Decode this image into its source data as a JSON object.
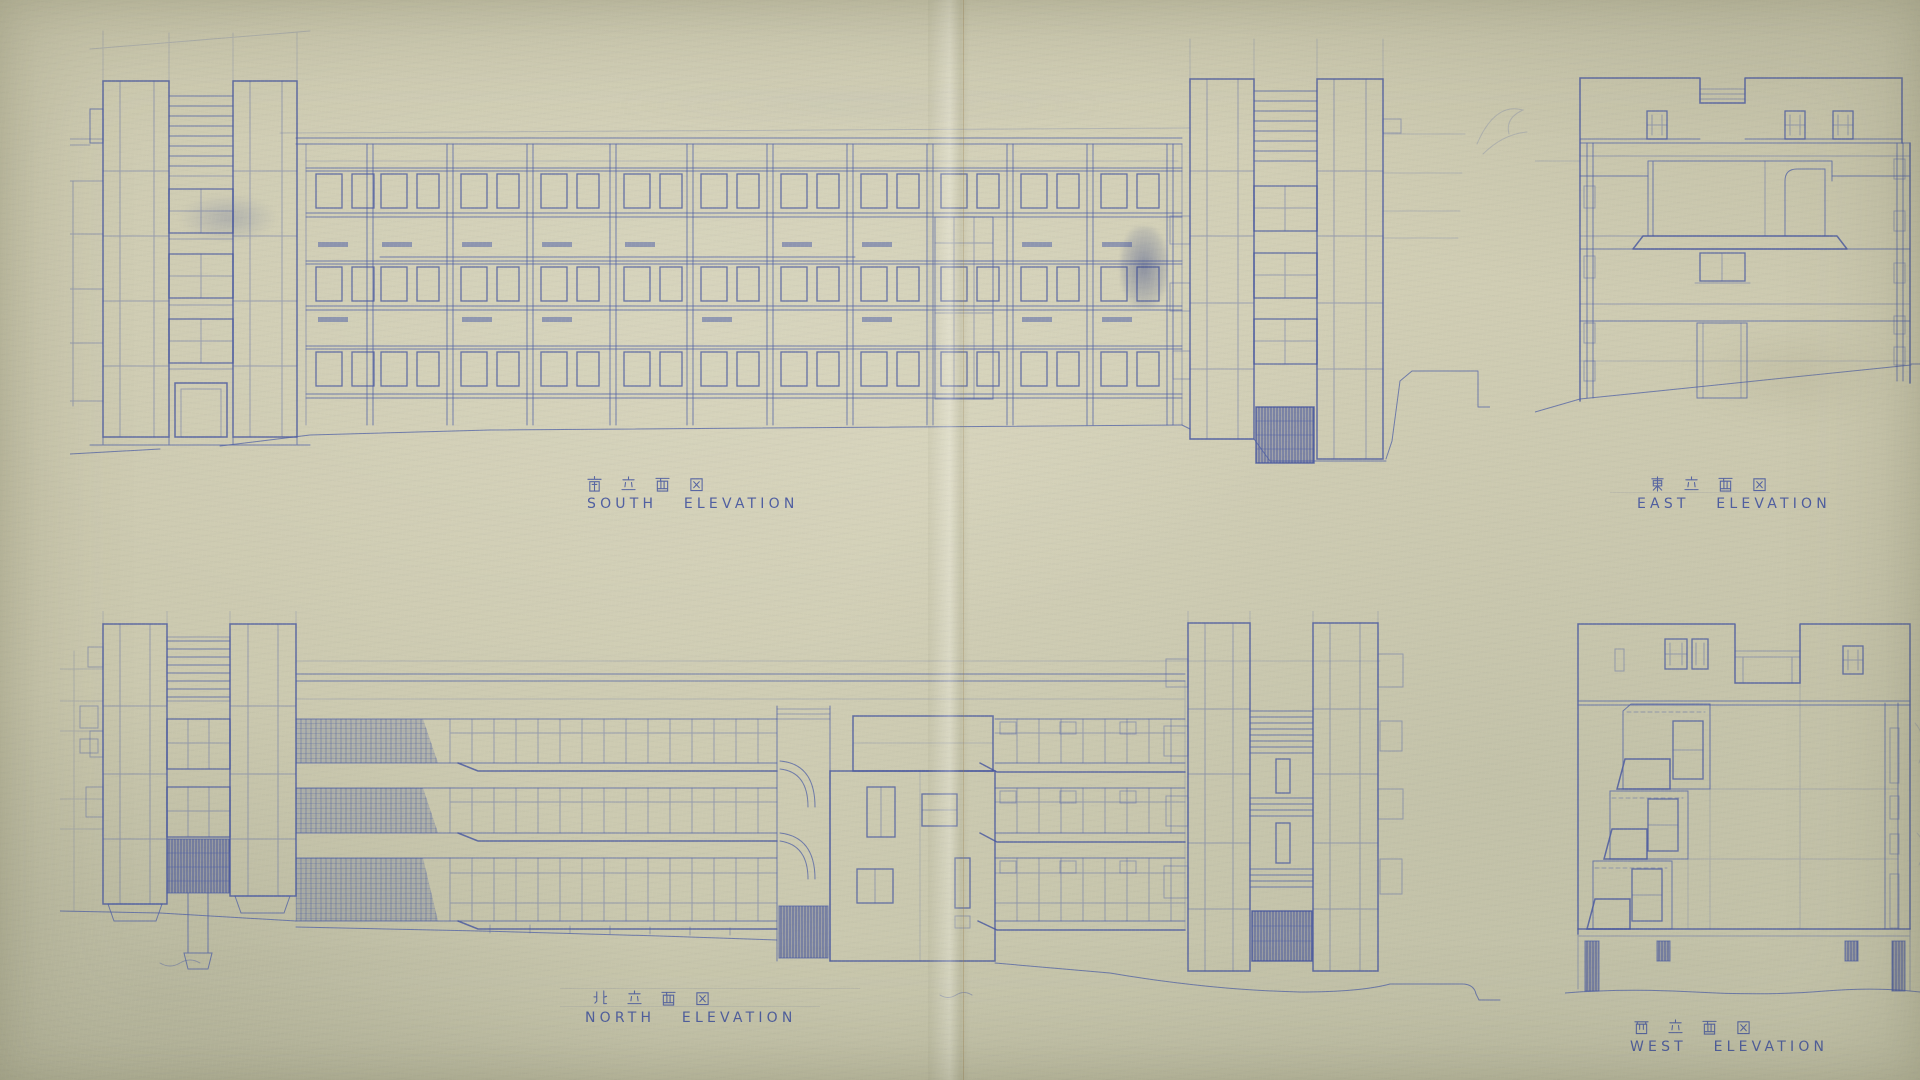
{
  "sheet": {
    "paper_color": "#cbc8ae",
    "ink_color": "#4a5ba5"
  },
  "elevations": {
    "south": {
      "kanji": "南立面図",
      "english": "SOUTH ELEVATION"
    },
    "east": {
      "kanji": "東立面図",
      "english": "EAST ELEVATION"
    },
    "north": {
      "kanji": "北立面図",
      "english": "NORTH ELEVATION"
    },
    "west": {
      "kanji": "西立面図",
      "english": "WEST ELEVATION"
    }
  }
}
